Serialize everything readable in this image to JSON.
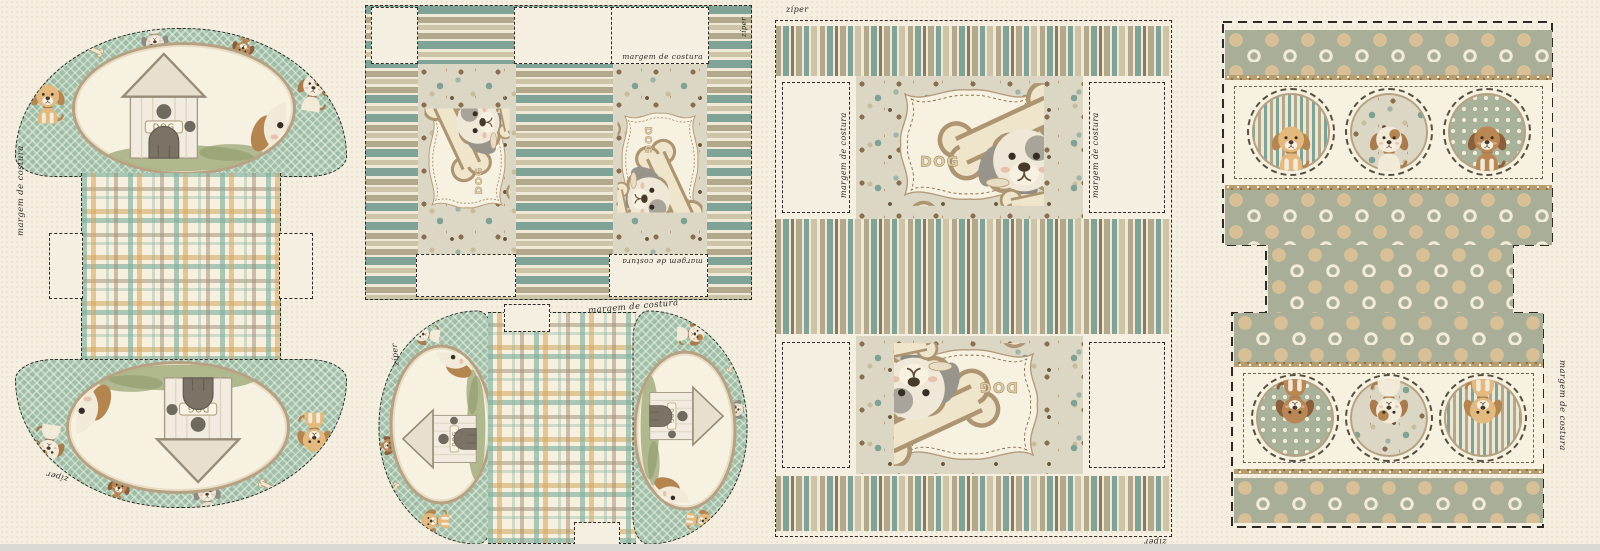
{
  "labels": {
    "seam_allowance": "margem de costura",
    "zipper": "zíper",
    "dog": "DOG"
  },
  "colors": {
    "bg": "#f5efe1",
    "bgdot": "#e9e1cb",
    "ink": "#2e2b26",
    "sage": "#a2bfa8",
    "teal": "#7fa396",
    "khaki": "#b2a88c",
    "khaki2": "#cdc3a6",
    "cream": "#f0e9d7",
    "brown": "#8a7a5e",
    "ochre": "#d3a45b",
    "tan": "#b6a183",
    "label": "#f7f1e1",
    "dotbg": "#dcd6c4",
    "polka": "#a8ae97",
    "polkatan": "#d8bf96",
    "mint": "#cfe2d6",
    "glitter": "#b69d70",
    "grass": "#a3ae7f",
    "fur_gold": "#e3b97d",
    "fur_white": "#f2ead9",
    "fur_brown": "#b98654",
    "fur_grey": "#e8e2d4",
    "ear_brown": "#b5854f"
  }
}
